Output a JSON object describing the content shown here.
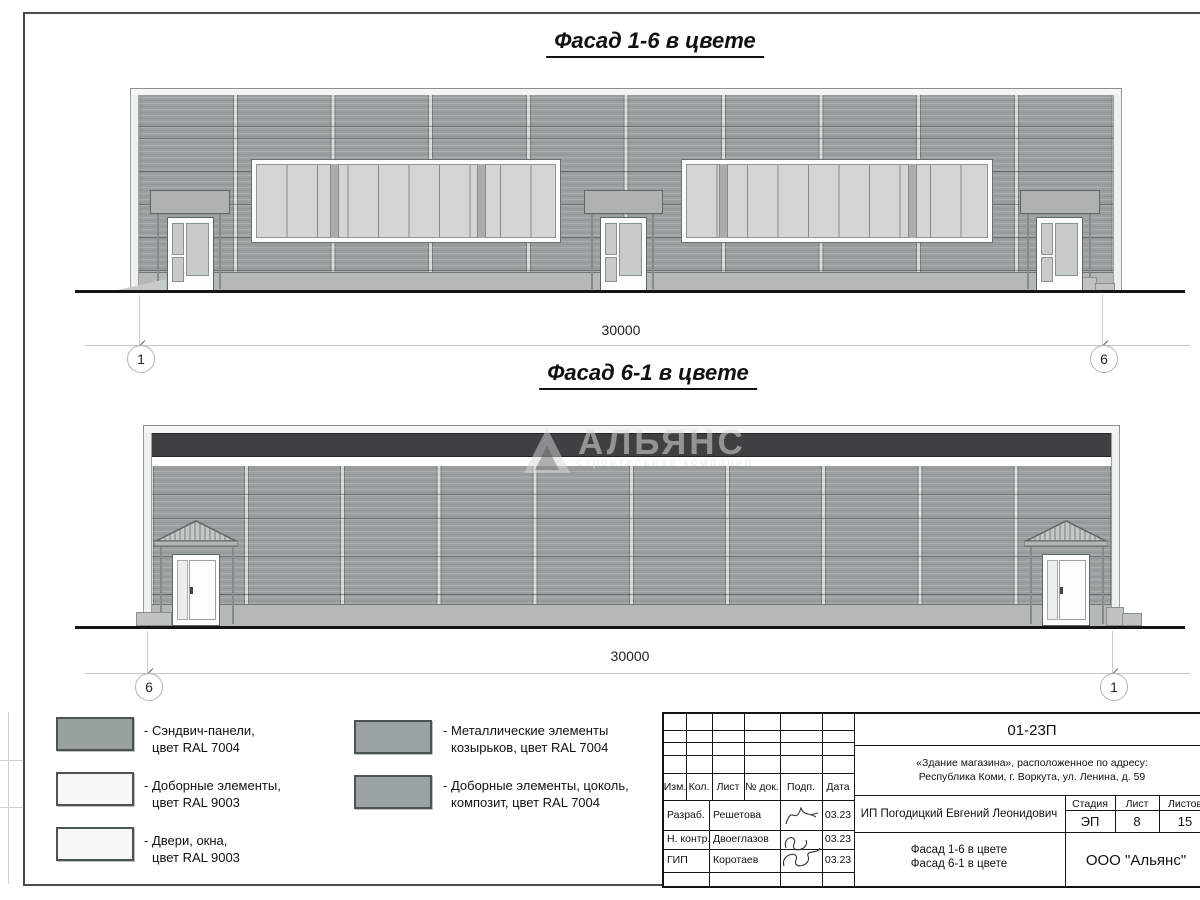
{
  "colors": {
    "wall": "#9aa09f",
    "dark_band": "#3e4141"
  },
  "titles": {
    "facade1": "Фасад 1-6 в цвете",
    "facade2": "Фасад 6-1 в цвете"
  },
  "facade1": {
    "dimension": "30000",
    "axis_left": "1",
    "axis_right": "6"
  },
  "facade2": {
    "dimension": "30000",
    "axis_left": "6",
    "axis_right": "1"
  },
  "watermark": {
    "logo": "АЛЬЯНС",
    "subtitle": "строительная компания"
  },
  "legend": {
    "items": [
      {
        "swatch": "#99a19f",
        "line1": "- Сэндвич-панели,",
        "line2": "цвет RAL 7004"
      },
      {
        "swatch": "#f6f7f6",
        "line1": "- Доборные элементы,",
        "line2": "цвет RAL 9003"
      },
      {
        "swatch": "#f6f7f6",
        "line1": "- Двери, окна,",
        "line2": "цвет RAL 9003"
      },
      {
        "swatch": "#9aa3a1",
        "line1": "- Металлические элементы",
        "line2": "козырьков, цвет RAL 7004"
      },
      {
        "swatch": "#9aa3a1",
        "line1": "- Доборные элементы, цоколь,",
        "line2": "композит, цвет RAL 7004"
      }
    ]
  },
  "stamp": {
    "doc_number": "01-23П",
    "object_line1": "«Здание магазина», расположенное по адресу:",
    "object_line2": "Республика Коми, г. Воркута, ул. Ленина, д. 59",
    "cols": [
      "Изм.",
      "Кол.",
      "Лист",
      "№ док.",
      "Подп.",
      "Дата"
    ],
    "rows": [
      {
        "role": "Разраб.",
        "name": "Решетова",
        "date": "03.23"
      },
      {
        "role": "Н. контр.",
        "name": "Двоеглазов",
        "date": "03.23"
      },
      {
        "role": "ГИП",
        "name": "Коротаев",
        "date": "03.23"
      }
    ],
    "client": "ИП Погодицкий Евгений Леонидович",
    "stage_label": "Стадия",
    "sheet_label": "Лист",
    "sheets_label": "Листов",
    "stage_value": "ЭП",
    "sheet_value": "8",
    "sheets_value": "15",
    "sheet_title_line1": "Фасад 1-6 в цвете",
    "sheet_title_line2": "Фасад 6-1 в цвете",
    "company": "ООО \"Альянс\""
  }
}
